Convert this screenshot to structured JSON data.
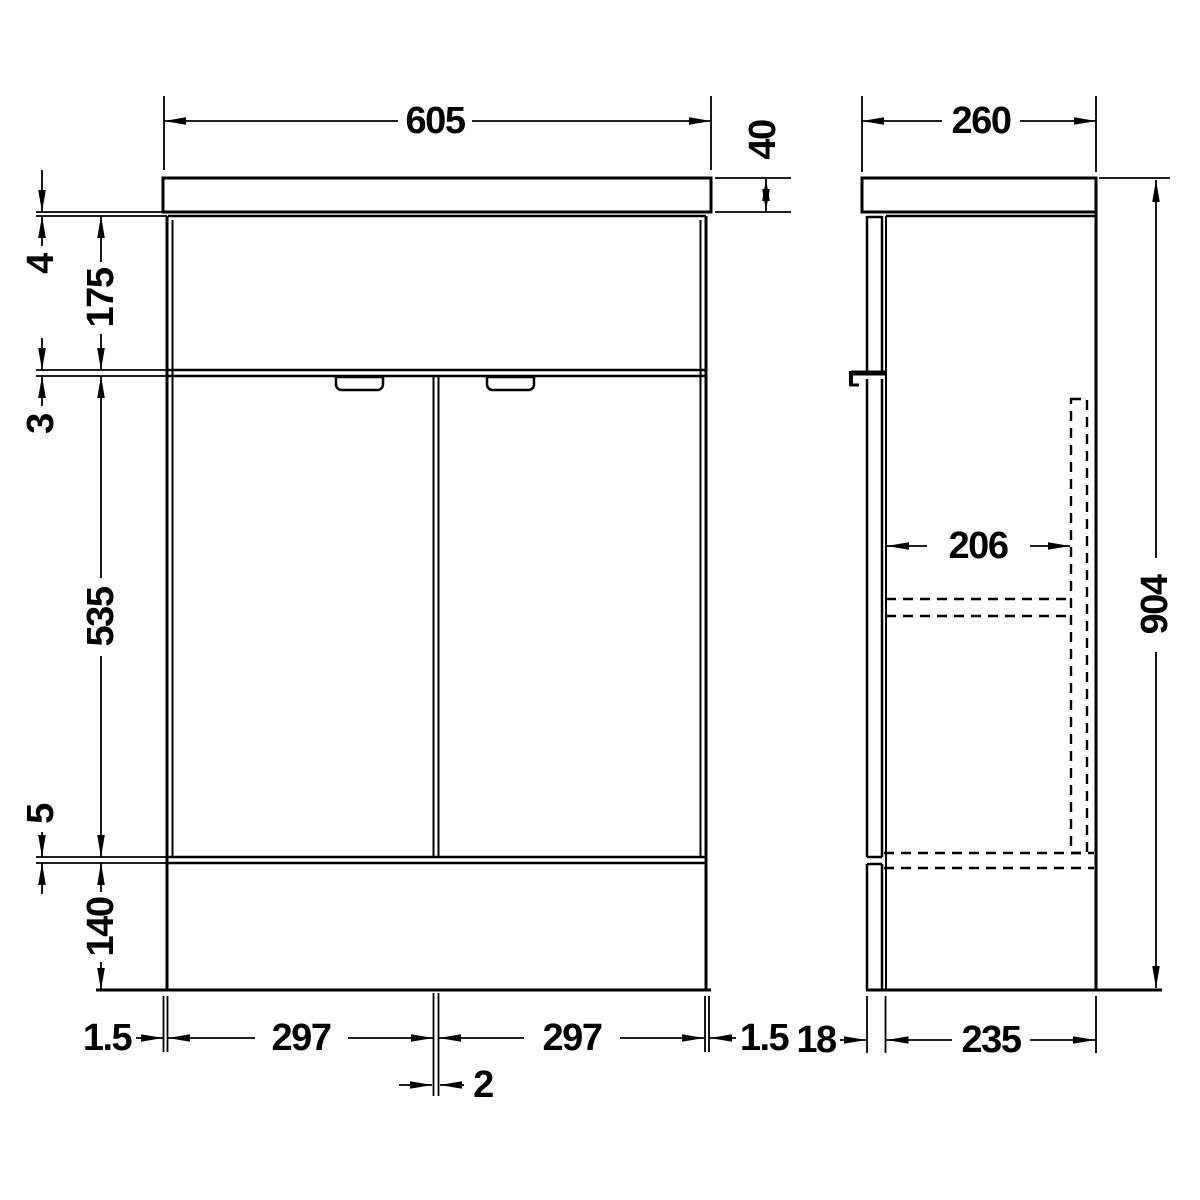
{
  "drawing": {
    "background": "#ffffff",
    "line_color": "#000000",
    "views": {
      "front": {
        "name": "front elevation",
        "dims": {
          "overall_width": "605",
          "worktop_thickness": "40",
          "top_gap": "4",
          "fascia_height": "175",
          "mid_gap": "3",
          "door_height": "535",
          "bottom_gap": "5",
          "plinth_height": "140",
          "left_inset": "1.5",
          "left_door_width": "297",
          "center_gap": "2",
          "right_door_width": "297",
          "right_inset": "1.5"
        }
      },
      "side": {
        "name": "side elevation",
        "dims": {
          "overall_depth": "260",
          "internal_depth": "206",
          "overall_height": "904",
          "door_thickness": "18",
          "carcass_depth": "235"
        }
      }
    }
  }
}
